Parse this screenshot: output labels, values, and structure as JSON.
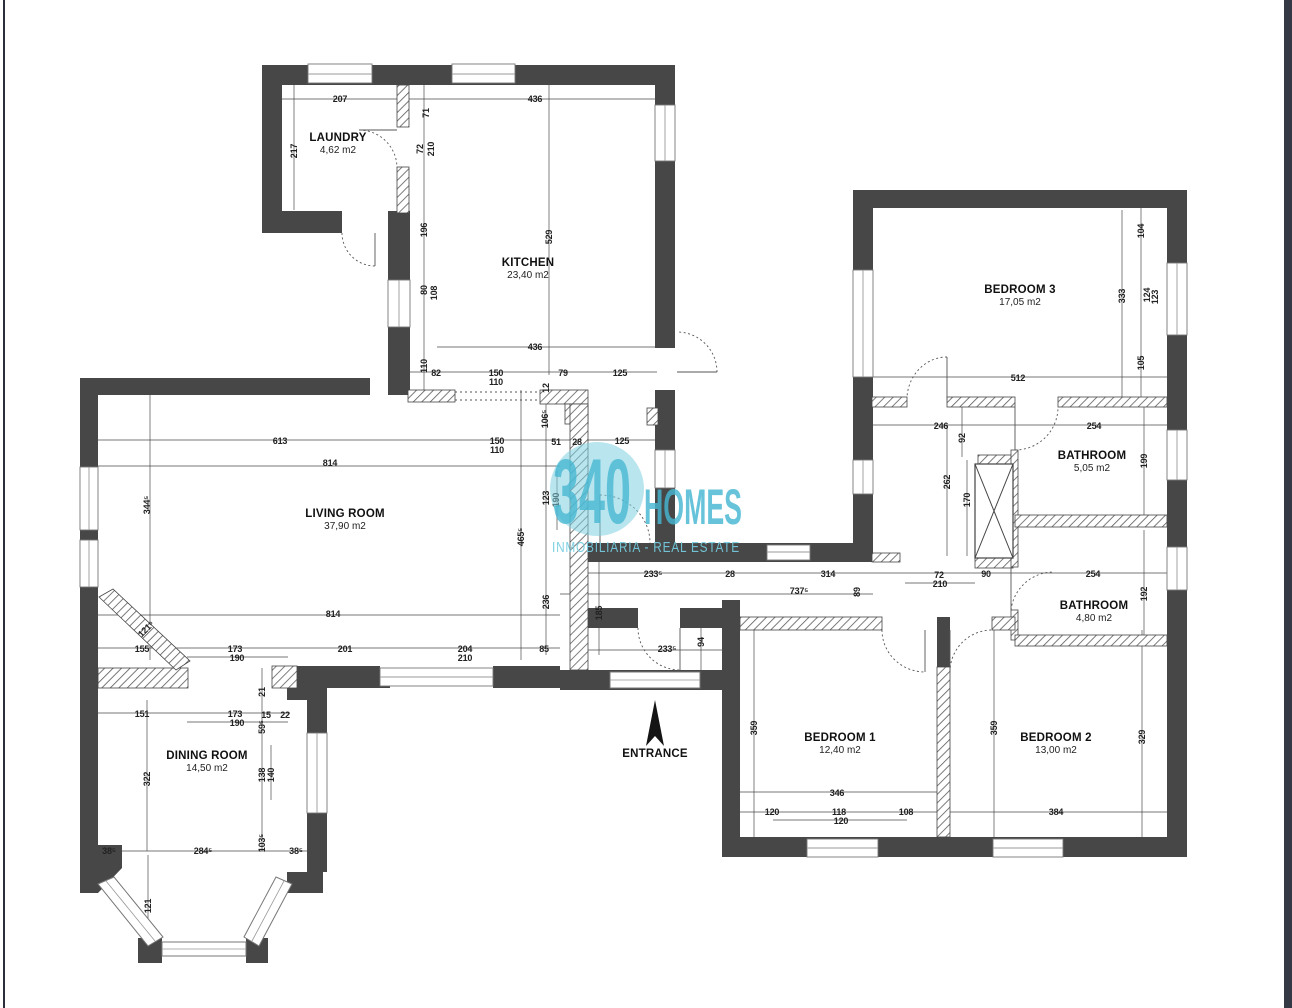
{
  "watermark": {
    "number": "340",
    "word": "HOMES",
    "tagline": "INMOBILIARIA - REAL ESTATE",
    "accent_color": "#45b7d2",
    "circle_color": "#7ecfe0"
  },
  "entrance": {
    "label": "ENTRANCE"
  },
  "rooms": [
    {
      "name": "LAUNDRY",
      "area": "4,62 m2",
      "x": 338,
      "y": 141
    },
    {
      "name": "KITCHEN",
      "area": "23,40 m2",
      "x": 528,
      "y": 266
    },
    {
      "name": "LIVING ROOM",
      "area": "37,90 m2",
      "x": 345,
      "y": 517
    },
    {
      "name": "DINING ROOM",
      "area": "14,50 m2",
      "x": 207,
      "y": 759
    },
    {
      "name": "BEDROOM 3",
      "area": "17,05 m2",
      "x": 1020,
      "y": 293
    },
    {
      "name": "BATHROOM",
      "area": "5,05 m2",
      "x": 1092,
      "y": 459
    },
    {
      "name": "BATHROOM",
      "area": "4,80 m2",
      "x": 1094,
      "y": 609
    },
    {
      "name": "BEDROOM 1",
      "area": "12,40 m2",
      "x": 840,
      "y": 741
    },
    {
      "name": "BEDROOM 2",
      "area": "13,00 m2",
      "x": 1056,
      "y": 741
    }
  ],
  "dims": [
    {
      "t": "207",
      "x": 340,
      "y": 99
    },
    {
      "t": "436",
      "x": 535,
      "y": 99
    },
    {
      "t": "217",
      "x": 294,
      "y": 151,
      "r": "v"
    },
    {
      "t": "71",
      "x": 426,
      "y": 113,
      "r": "v"
    },
    {
      "t": "72",
      "x": 420,
      "y": 149,
      "r": "v"
    },
    {
      "t": "210",
      "x": 431,
      "y": 149,
      "r": "v"
    },
    {
      "t": "196",
      "x": 424,
      "y": 230,
      "r": "v"
    },
    {
      "t": "529",
      "x": 549,
      "y": 237,
      "r": "v"
    },
    {
      "t": "80",
      "x": 424,
      "y": 290,
      "r": "v"
    },
    {
      "t": "108",
      "x": 434,
      "y": 293,
      "r": "v"
    },
    {
      "t": "110",
      "x": 424,
      "y": 366,
      "r": "v"
    },
    {
      "t": "436",
      "x": 535,
      "y": 347
    },
    {
      "t": "82",
      "x": 436,
      "y": 373
    },
    {
      "t": "150",
      "x": 496,
      "y": 373
    },
    {
      "t": "110",
      "x": 496,
      "y": 382
    },
    {
      "t": "79",
      "x": 563,
      "y": 373
    },
    {
      "t": "125",
      "x": 620,
      "y": 373
    },
    {
      "t": "12",
      "x": 546,
      "y": 388,
      "r": "v"
    },
    {
      "t": "613",
      "x": 280,
      "y": 441
    },
    {
      "t": "150",
      "x": 497,
      "y": 441
    },
    {
      "t": "110",
      "x": 497,
      "y": 450
    },
    {
      "t": "51",
      "x": 556,
      "y": 442
    },
    {
      "t": "28",
      "x": 577,
      "y": 442
    },
    {
      "t": "125",
      "x": 622,
      "y": 441
    },
    {
      "t": "106⁵",
      "x": 545,
      "y": 419,
      "r": "v"
    },
    {
      "t": "814",
      "x": 330,
      "y": 463
    },
    {
      "t": "344⁵",
      "x": 147,
      "y": 505,
      "r": "v"
    },
    {
      "t": "123",
      "x": 546,
      "y": 498,
      "r": "v"
    },
    {
      "t": "190",
      "x": 556,
      "y": 500,
      "r": "v"
    },
    {
      "t": "465⁵",
      "x": 521,
      "y": 537,
      "r": "v"
    },
    {
      "t": "236",
      "x": 546,
      "y": 602,
      "r": "v"
    },
    {
      "t": "185",
      "x": 599,
      "y": 613,
      "r": "v"
    },
    {
      "t": "814",
      "x": 333,
      "y": 614
    },
    {
      "t": "155",
      "x": 142,
      "y": 649
    },
    {
      "t": "173",
      "x": 235,
      "y": 649
    },
    {
      "t": "190",
      "x": 237,
      "y": 658
    },
    {
      "t": "201",
      "x": 345,
      "y": 649
    },
    {
      "t": "204",
      "x": 465,
      "y": 649
    },
    {
      "t": "210",
      "x": 465,
      "y": 658
    },
    {
      "t": "85",
      "x": 544,
      "y": 649
    },
    {
      "t": "121⁵",
      "x": 146,
      "y": 629,
      "r": "d"
    },
    {
      "t": "233⁵",
      "x": 653,
      "y": 574
    },
    {
      "t": "28",
      "x": 730,
      "y": 574
    },
    {
      "t": "314",
      "x": 828,
      "y": 574
    },
    {
      "t": "72",
      "x": 939,
      "y": 575
    },
    {
      "t": "210",
      "x": 940,
      "y": 584
    },
    {
      "t": "737⁵",
      "x": 799,
      "y": 591
    },
    {
      "t": "89",
      "x": 857,
      "y": 592,
      "r": "v"
    },
    {
      "t": "233⁵",
      "x": 667,
      "y": 649
    },
    {
      "t": "94",
      "x": 701,
      "y": 642,
      "r": "v"
    },
    {
      "t": "359",
      "x": 754,
      "y": 728,
      "r": "v"
    },
    {
      "t": "151",
      "x": 142,
      "y": 714
    },
    {
      "t": "173",
      "x": 235,
      "y": 714
    },
    {
      "t": "190",
      "x": 237,
      "y": 723
    },
    {
      "t": "15",
      "x": 266,
      "y": 715
    },
    {
      "t": "22",
      "x": 285,
      "y": 715
    },
    {
      "t": "21",
      "x": 262,
      "y": 692,
      "r": "v"
    },
    {
      "t": "59⁵",
      "x": 262,
      "y": 727,
      "r": "v"
    },
    {
      "t": "138",
      "x": 262,
      "y": 775,
      "r": "v"
    },
    {
      "t": "140",
      "x": 271,
      "y": 775,
      "r": "v"
    },
    {
      "t": "322",
      "x": 147,
      "y": 779,
      "r": "v"
    },
    {
      "t": "103⁵",
      "x": 262,
      "y": 843,
      "r": "v"
    },
    {
      "t": "38⁵",
      "x": 109,
      "y": 851
    },
    {
      "t": "284⁵",
      "x": 203,
      "y": 851
    },
    {
      "t": "38⁵",
      "x": 296,
      "y": 851
    },
    {
      "t": "121",
      "x": 148,
      "y": 906,
      "r": "v"
    },
    {
      "t": "512",
      "x": 1018,
      "y": 378
    },
    {
      "t": "246",
      "x": 941,
      "y": 426
    },
    {
      "t": "254",
      "x": 1094,
      "y": 426
    },
    {
      "t": "92",
      "x": 962,
      "y": 438,
      "r": "v"
    },
    {
      "t": "262",
      "x": 947,
      "y": 482,
      "r": "v"
    },
    {
      "t": "170",
      "x": 967,
      "y": 500,
      "r": "v"
    },
    {
      "t": "199",
      "x": 1144,
      "y": 461,
      "r": "v"
    },
    {
      "t": "90",
      "x": 986,
      "y": 574
    },
    {
      "t": "254",
      "x": 1093,
      "y": 574
    },
    {
      "t": "192",
      "x": 1144,
      "y": 594,
      "r": "v"
    },
    {
      "t": "333",
      "x": 1122,
      "y": 296,
      "r": "v"
    },
    {
      "t": "104",
      "x": 1141,
      "y": 231,
      "r": "v"
    },
    {
      "t": "124",
      "x": 1147,
      "y": 295,
      "r": "v"
    },
    {
      "t": "123",
      "x": 1155,
      "y": 297,
      "r": "v"
    },
    {
      "t": "105",
      "x": 1141,
      "y": 363,
      "r": "v"
    },
    {
      "t": "359",
      "x": 994,
      "y": 728,
      "r": "v"
    },
    {
      "t": "329",
      "x": 1142,
      "y": 737,
      "r": "v"
    },
    {
      "t": "346",
      "x": 837,
      "y": 793
    },
    {
      "t": "120",
      "x": 772,
      "y": 812
    },
    {
      "t": "118",
      "x": 839,
      "y": 812
    },
    {
      "t": "120",
      "x": 841,
      "y": 821
    },
    {
      "t": "108",
      "x": 906,
      "y": 812
    },
    {
      "t": "384",
      "x": 1056,
      "y": 812
    }
  ]
}
